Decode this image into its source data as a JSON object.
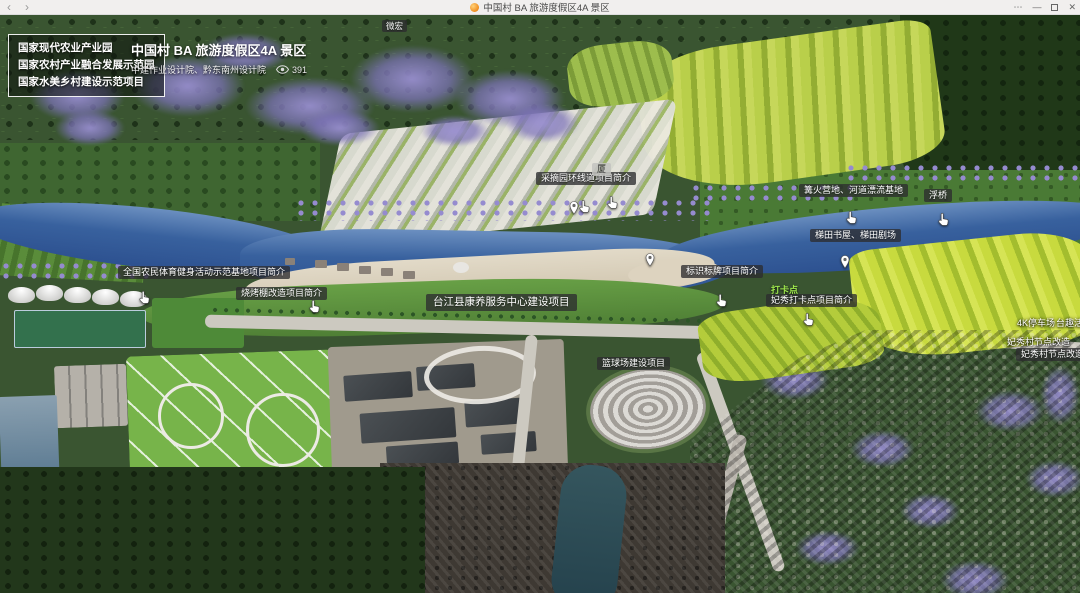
{
  "window": {
    "title": "中国村 BA 旅游度假区4A 景区",
    "back": "‹",
    "forward": "›",
    "more": "⋯",
    "minimize": "—",
    "close": "✕"
  },
  "header": {
    "badges": [
      "国家现代农业产业园",
      "国家农村产业融合发展示范园",
      "国家水美乡村建设示范项目"
    ],
    "title": "中国村 BA 旅游度假区4A 景区",
    "subtitle": "中建作业设计院、黔东南州设计院",
    "views": "391"
  },
  "map": {
    "labels": [
      {
        "id": "weihong",
        "text": "微宏",
        "x": 382,
        "y": 20,
        "style": "sm"
      },
      {
        "id": "caizhaiyuan",
        "text": "采摘园环线道项目简介",
        "x": 536,
        "y": 172,
        "style": ""
      },
      {
        "id": "daxia",
        "text": "厦",
        "x": 592,
        "y": 163,
        "style": "light"
      },
      {
        "id": "gouhuo",
        "text": "篝火营地、河道漂流基地",
        "x": 799,
        "y": 184,
        "style": ""
      },
      {
        "id": "fuqiao",
        "text": "浮桥",
        "x": 924,
        "y": 189,
        "style": ""
      },
      {
        "id": "titian-shuwu",
        "text": "梯田书屋、梯田剧场",
        "x": 810,
        "y": 229,
        "style": ""
      },
      {
        "id": "biaoshi",
        "text": "标识标牌项目简介",
        "x": 681,
        "y": 265,
        "style": ""
      },
      {
        "id": "dakadian",
        "text": "打卡点",
        "x": 771,
        "y": 284,
        "style": "text-green"
      },
      {
        "id": "feixiu-daka",
        "text": "妃秀打卡点项目简介",
        "x": 766,
        "y": 294,
        "style": ""
      },
      {
        "id": "quanguo",
        "text": "全国农民体育健身活动示范基地项目简介",
        "x": 118,
        "y": 266,
        "style": ""
      },
      {
        "id": "shaokao",
        "text": "烧烤棚改造项目简介",
        "x": 236,
        "y": 287,
        "style": ""
      },
      {
        "id": "kangyang",
        "text": "台江县康养服务中心建设项目",
        "x": 426,
        "y": 294,
        "style": "big"
      },
      {
        "id": "lanqiuchang",
        "text": "篮球场建设项目",
        "x": 597,
        "y": 357,
        "style": ""
      },
      {
        "id": "parking",
        "text": "4K停车场",
        "x": 1017,
        "y": 317,
        "style": "text-white"
      },
      {
        "id": "taiqu",
        "text": "台趣活动",
        "x": 1056,
        "y": 317,
        "style": "text-white"
      },
      {
        "id": "feixiu-node",
        "text": "妃秀村节点改造",
        "x": 1007,
        "y": 336,
        "style": "text-white"
      },
      {
        "id": "feixiu-jianjie",
        "text": "妃秀村节点改造项目简介",
        "x": 1016,
        "y": 348,
        "style": ""
      }
    ],
    "hand_cursors": [
      [
        578,
        199
      ],
      [
        606,
        195
      ],
      [
        845,
        210
      ],
      [
        937,
        212
      ],
      [
        715,
        293
      ],
      [
        138,
        290
      ],
      [
        308,
        299
      ],
      [
        802,
        312
      ]
    ],
    "pins": [
      [
        840,
        255
      ],
      [
        569,
        201
      ],
      [
        645,
        253
      ]
    ]
  },
  "toolbar": {
    "icons": [
      {
        "name": "trash-icon",
        "glyph": "trash",
        "y": 218
      },
      {
        "name": "fullscreen-icon",
        "glyph": "expand",
        "y": 244
      },
      {
        "name": "camera-icon",
        "glyph": "camera",
        "y": 270
      },
      {
        "name": "globe-icon",
        "glyph": "globe",
        "y": 297
      },
      {
        "name": "share-icon",
        "glyph": "share",
        "y": 327
      },
      {
        "name": "compass-icon",
        "glyph": "compass",
        "y": 349
      }
    ]
  },
  "colors": {
    "river": "#38619e",
    "terrace": "#b9cf4a",
    "purple_trees": "#958bcf",
    "label_bg": "rgba(45,45,48,0.78)"
  }
}
